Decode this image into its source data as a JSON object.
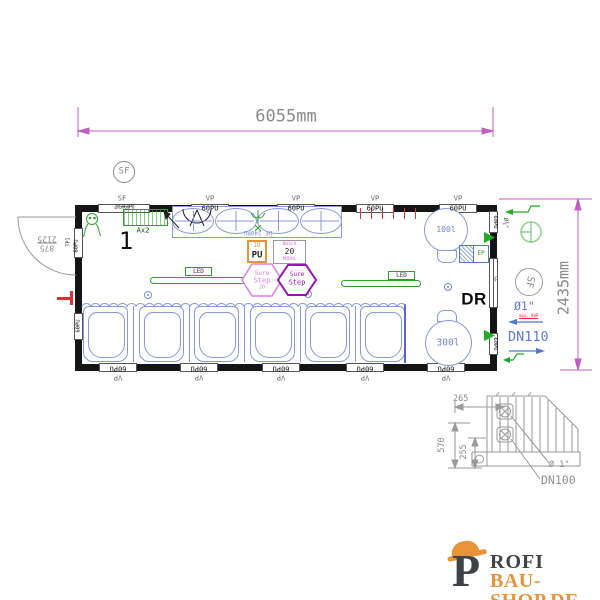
{
  "dimensions": {
    "overall_width": "6055mm",
    "overall_height": "2435mm",
    "door_width": "875",
    "door_clearance": "2125"
  },
  "symbols": {
    "sf_circle_top": "SF",
    "sf_circle_right": "SF"
  },
  "top_wall": {
    "sf": "SF",
    "panel": "2mSH60PU",
    "vp": [
      "VP",
      "VP",
      "VP",
      "VP"
    ],
    "pu": [
      "60PU",
      "60PU",
      "60PU",
      "60PU"
    ]
  },
  "bottom_wall": {
    "vp": [
      "VP",
      "VP",
      "VP",
      "VP",
      "VP"
    ],
    "pu": [
      "60PU",
      "60PU",
      "60PU",
      "60PU",
      "60PU"
    ]
  },
  "left_wall": {
    "tp1": "TP1",
    "pu_top": "60PU",
    "pu_bottom": "60PU"
  },
  "right_wall": {
    "pu_top": "60PU",
    "sf": "SF",
    "pu_bottom": "60PU"
  },
  "room": {
    "number": "1",
    "heater": "Ax2",
    "urinal_model": "ÜF 240RU",
    "led_left": "LED",
    "led_right": "LED",
    "pu_box": {
      "line1": "ID",
      "line2": "PU"
    },
    "bosch_box": {
      "line1": "BOSCH",
      "line2": "20",
      "line3": "MODUL"
    },
    "hex_pink": {
      "line1": "Sure",
      "line2": "Step",
      "line3": "20"
    },
    "hex_purple": {
      "line1": "Sure",
      "line2": "Step"
    },
    "boiler_small": "100l",
    "boiler_large": "300l",
    "panel": "EP",
    "dr": "DR"
  },
  "connections": {
    "inlet": "Ø¾\"",
    "water": "Ø1\"",
    "water_note": "max. 80P",
    "drain": "DN110"
  },
  "detail": {
    "dim_265": "265",
    "dim_570": "570",
    "dim_255": "255",
    "pipe": "Ø 1\"",
    "drain": "DN100"
  },
  "logo": {
    "initial": "P",
    "name_rest": "ROFI",
    "domain": "BAU-SHOP.DE"
  }
}
